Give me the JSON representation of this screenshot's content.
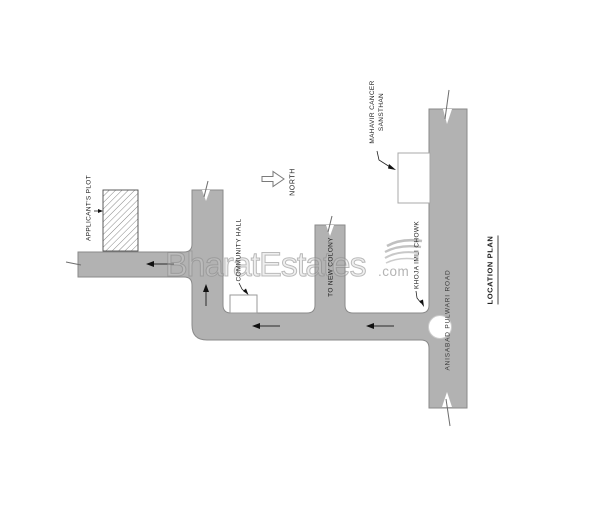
{
  "plan": {
    "title": "LOCATION PLAN",
    "north_label": "NORTH",
    "road_label": "ANISABAD PULWARI ROAD",
    "labels": {
      "applicants_plot": "APPLICANT'S PLOT",
      "community_hall": "COMMUNITY HALL",
      "to_new_colony": "TO NEW COLONY",
      "mahavir_cancer_line1": "MAHAVIR CANCER",
      "mahavir_cancer_line2": "SANSTHAN",
      "khoja_imli_chowk": "KHOJA IMLI CHOWK"
    }
  },
  "watermark": {
    "brand": "BharatEstates",
    "suffix": ".com"
  },
  "colors": {
    "background": "#ffffff",
    "road_fill": "#b2b2b2",
    "road_edge": "#8a8a8a",
    "label_text": "#1f1f1f",
    "arrow_black": "#1c1c1c",
    "watermark_gray": "#a9a9a9"
  },
  "icons": {
    "north_arrow": "hollow-block-arrow-right",
    "watermark_leaf": "leaf-swoosh",
    "traffic_arrows": "solid-triangle-arrows",
    "road_break_marks": "break-tick"
  }
}
